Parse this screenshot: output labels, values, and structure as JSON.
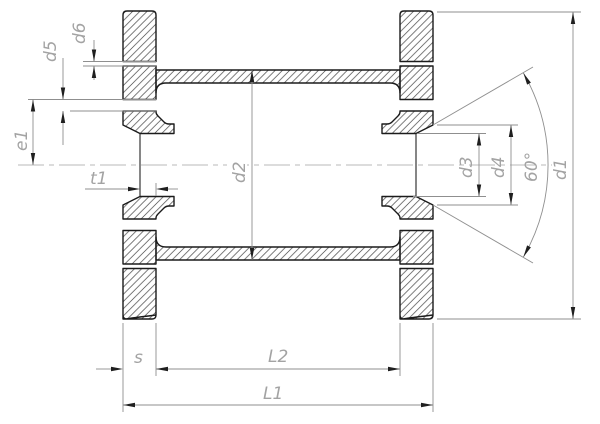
{
  "drawing": {
    "title": "flanged-socket-coupling-cross-section",
    "labels": {
      "d1": "d1",
      "d2": "d2",
      "d3": "d3",
      "d4": "d4",
      "d5": "d5",
      "d6": "d6",
      "e1": "e1",
      "t1": "t1",
      "s": "s",
      "L1": "L1",
      "L2": "L2",
      "angle": "60°"
    },
    "colors": {
      "background": "#ffffff",
      "outline": "#1b1b1b",
      "hatch": "#4a4a4a",
      "dimension_line": "#8f8f8f",
      "arrow": "#1f1f1f",
      "label_text": "#a3a3a3",
      "centerline": "#b9b9b9"
    }
  }
}
